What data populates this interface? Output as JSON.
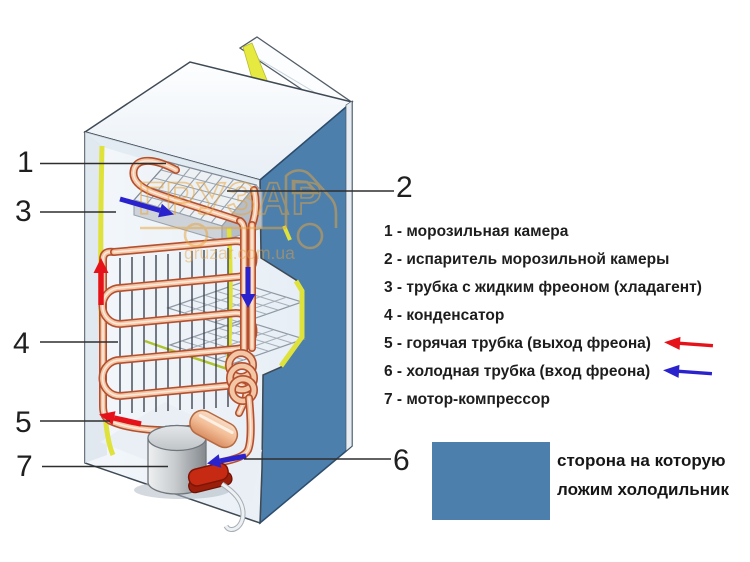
{
  "watermark": {
    "brand": "ГРУЗАР",
    "domain": "gruzar.com.ua"
  },
  "callouts": {
    "c1": "1",
    "c2": "2",
    "c3": "3",
    "c4": "4",
    "c5": "5",
    "c6": "6",
    "c7": "7"
  },
  "legend": {
    "items": [
      {
        "label": "1 - морозильная камера",
        "arrow": ""
      },
      {
        "label": "2 - испаритель морозильной камеры",
        "arrow": ""
      },
      {
        "label": "3 - трубка с жидким фреоном (хладагент)",
        "arrow": ""
      },
      {
        "label": "4 - конденсатор",
        "arrow": ""
      },
      {
        "label": "5 - горячая трубка (выход фреона)",
        "arrow": "red"
      },
      {
        "label": "6 - холодная трубка (вход фреона)",
        "arrow": "blue"
      },
      {
        "label": "7 - мотор-компрессор",
        "arrow": ""
      }
    ]
  },
  "orientation_note": {
    "line1": "сторона на которую",
    "line2": "ложим холодильник",
    "swatch_color": "#4D7FAC"
  },
  "colors": {
    "hot_flow": "#E51219",
    "cold_flow": "#2A22CC",
    "side_panel": "#4D7FAC",
    "copper_tube": "#C05A3A",
    "insulation": "#DFE23A",
    "watermark": "#E9A33B"
  }
}
